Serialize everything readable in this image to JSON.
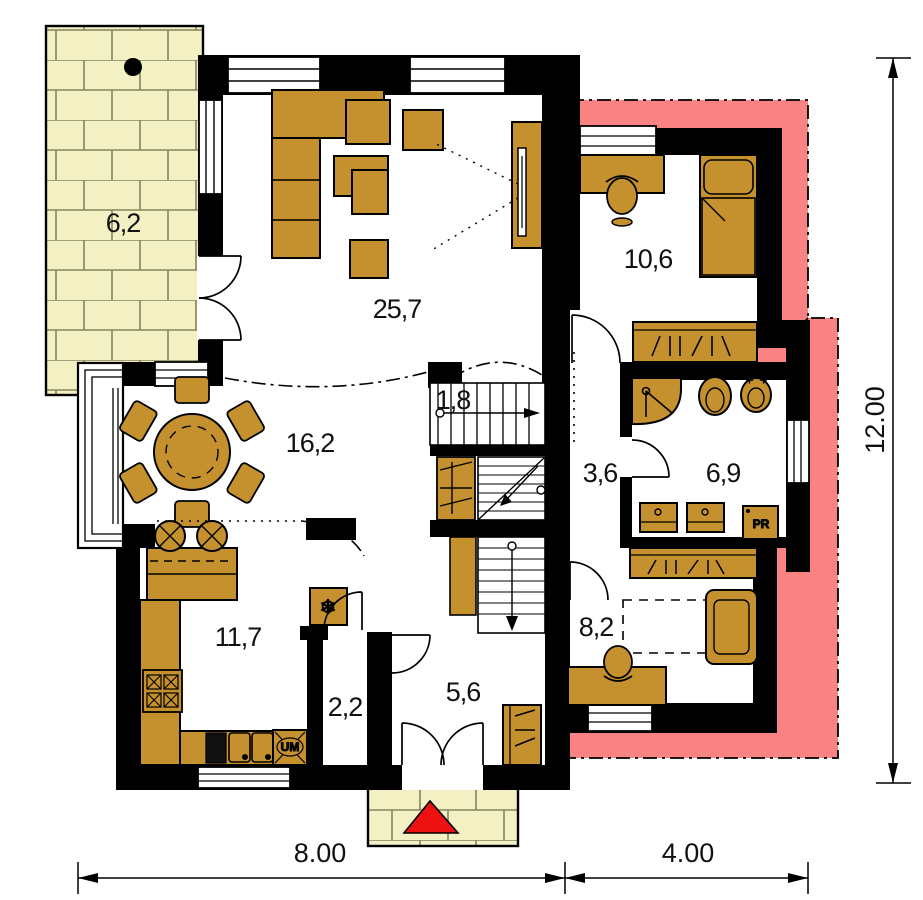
{
  "plan": {
    "rooms": {
      "terrace": {
        "area": "6,2"
      },
      "living": {
        "area": "25,7"
      },
      "bedroom": {
        "area": "10,6"
      },
      "dining": {
        "area": "16,2"
      },
      "stairs": {
        "area": "1,8"
      },
      "hall": {
        "area": "3,6"
      },
      "bath": {
        "area": "6,9"
      },
      "kitchen": {
        "area": "11,7"
      },
      "pantry": {
        "area": "2,2"
      },
      "entry": {
        "area": "5,6"
      },
      "study": {
        "area": "8,2"
      }
    },
    "appliances": {
      "dishwasher_label": "UM",
      "washer_label": "PR"
    },
    "dimensions": {
      "bottom_left": "8.00",
      "bottom_right": "4.00",
      "right": "12.00"
    },
    "icons": {
      "freezer": "❄"
    },
    "colors": {
      "furniture": "#c5912e",
      "terrace_brick": "#f3f1c4",
      "extension_highlight": "#f98383",
      "entrance_marker": "#ee1111",
      "wall": "#000000"
    }
  }
}
